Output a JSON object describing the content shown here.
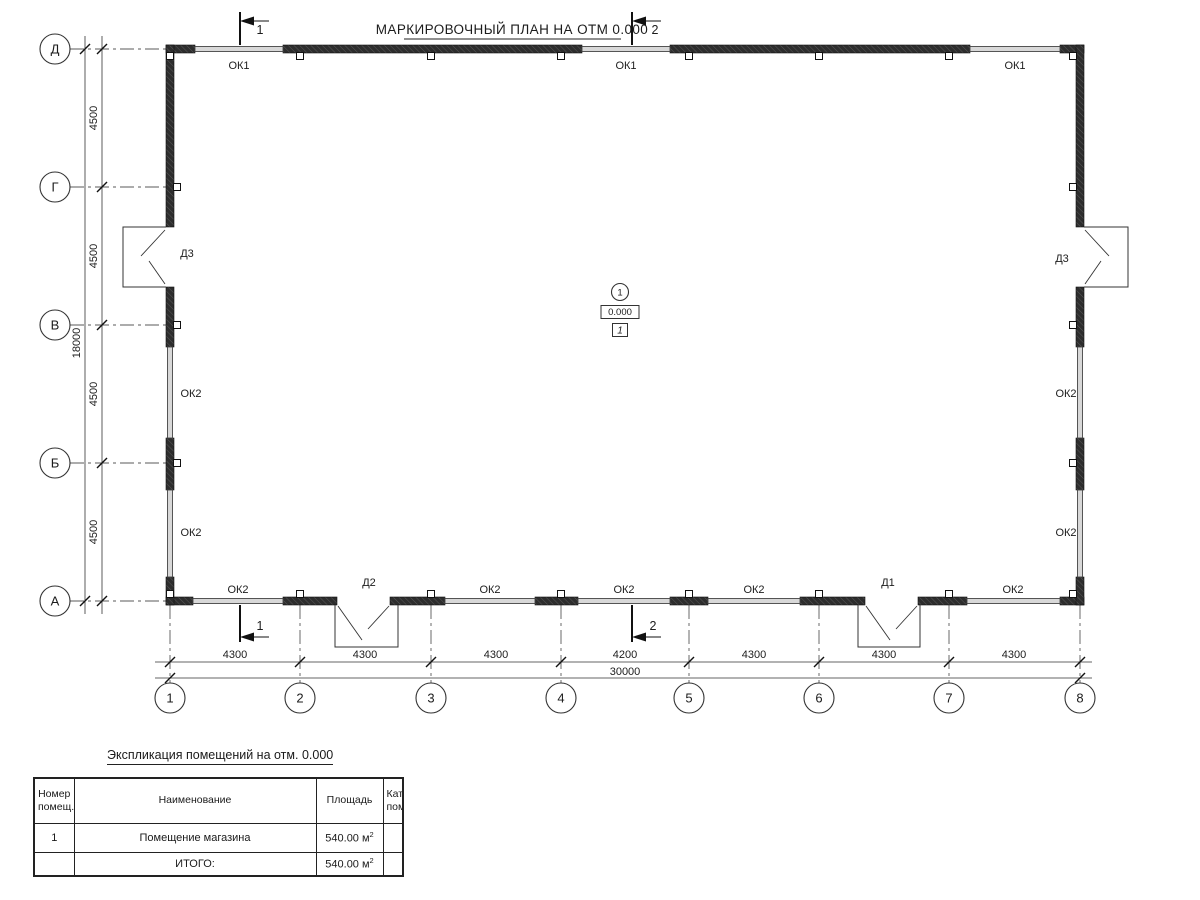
{
  "plan": {
    "title": "МАРКИРОВОЧНЫЙ ПЛАН НА ОТМ 0.000",
    "axis_rows": [
      "Д",
      "Г",
      "В",
      "Б",
      "А"
    ],
    "axis_cols": [
      "1",
      "2",
      "3",
      "4",
      "5",
      "6",
      "7",
      "8"
    ],
    "dim_row_segments": [
      "4500",
      "4500",
      "4500",
      "4500"
    ],
    "dim_row_total": "18000",
    "dim_col_segments": [
      "4300",
      "4300",
      "4300",
      "4200",
      "4300",
      "4300",
      "4300"
    ],
    "dim_col_total": "30000",
    "marks": {
      "window_type1": "ОК1",
      "window_type2": "ОК2",
      "door1": "Д1",
      "door2": "Д2",
      "door3": "Д3",
      "section1": "1",
      "section2": "2"
    },
    "room_tag": {
      "number": "1",
      "elevation": "0.000",
      "box_number": "1"
    }
  },
  "table": {
    "title": "Экспликация помещений на отм. 0.000",
    "col_number": "Номер\nпомещ.",
    "col_name": "Наименование",
    "col_area": "Площадь",
    "col_cat": "Кат.\nпом.",
    "rows": [
      {
        "number": "1",
        "name": "Помещение магазина",
        "area": "540.00 м",
        "area_sup": "2",
        "cat": ""
      },
      {
        "number": "",
        "name": "ИТОГО:",
        "area": "540.00 м",
        "area_sup": "2",
        "cat": ""
      }
    ]
  }
}
